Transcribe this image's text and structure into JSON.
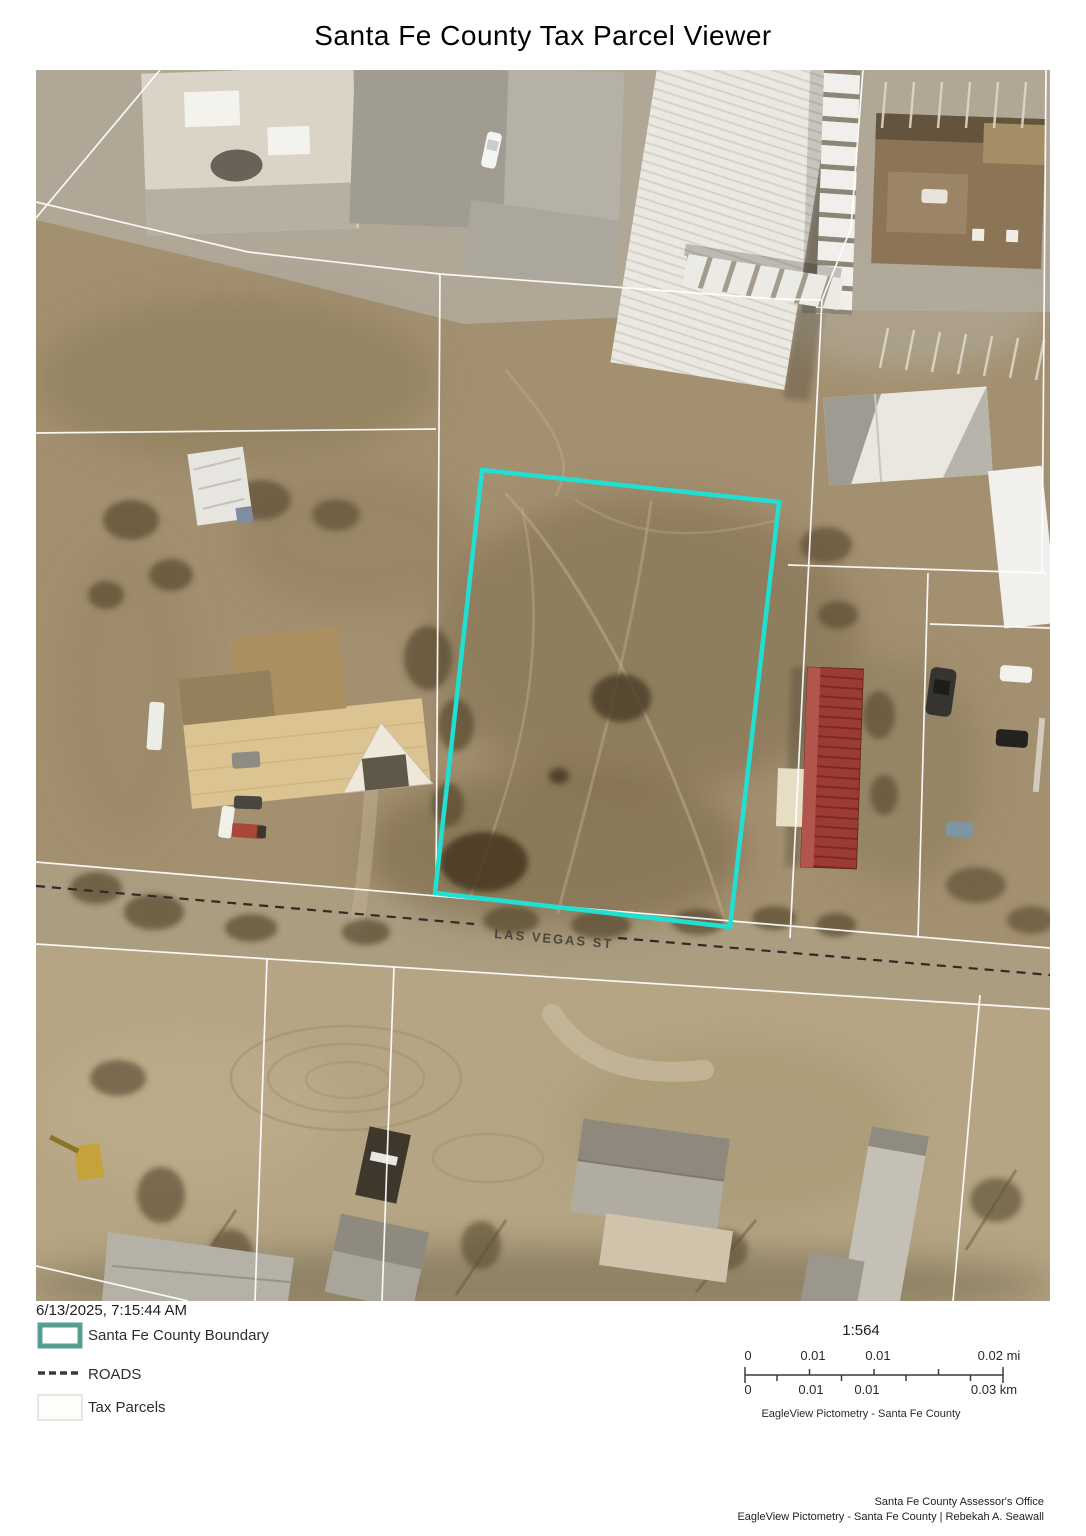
{
  "title": "Santa Fe County Tax Parcel Viewer",
  "map": {
    "street_label": "LAS VEGAS ST",
    "highlight_color": "#22dfd2"
  },
  "footer": {
    "timestamp": "6/13/2025, 7:15:44 AM",
    "legend": {
      "county_boundary": {
        "label": "Santa Fe County Boundary",
        "color": "#53a093"
      },
      "roads": {
        "label": "ROADS"
      },
      "tax_parcels": {
        "label": "Tax Parcels"
      }
    },
    "scale": {
      "ratio": "1:564",
      "miles_labels": [
        "0",
        "0.01",
        "0.01",
        "0.02 mi"
      ],
      "km_labels": [
        "0",
        "0.01",
        "0.01",
        "0.03 km"
      ],
      "credit": "EagleView Pictometry - Santa Fe County"
    },
    "attribution": {
      "line1": "Santa Fe County Assessor's Office",
      "line2": "EagleView Pictometry - Santa Fe County | Rebekah A. Seawall"
    }
  }
}
